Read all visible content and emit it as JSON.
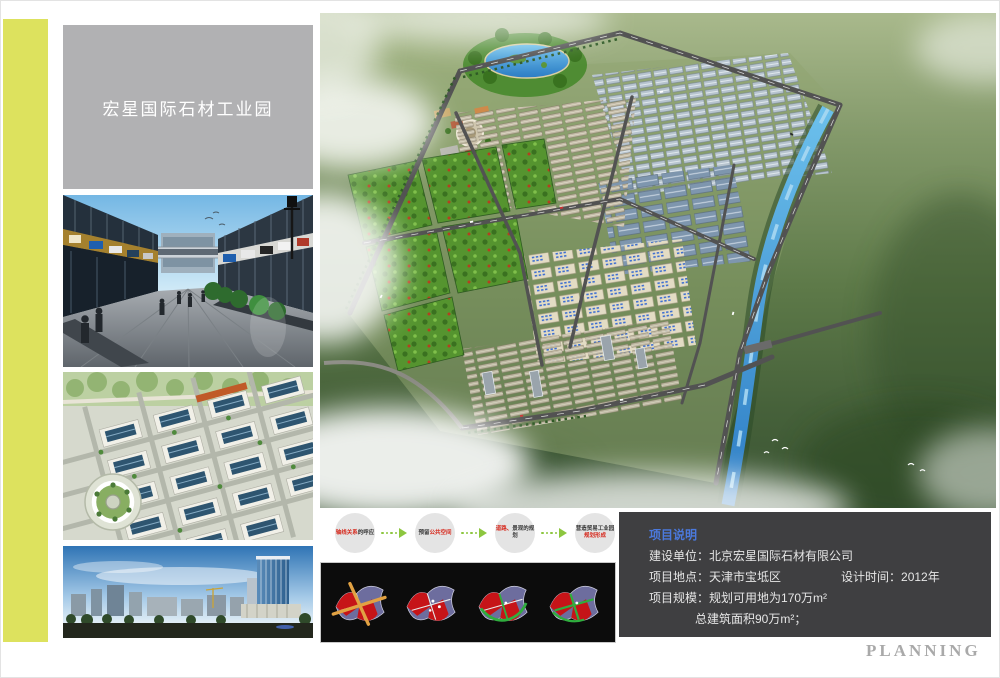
{
  "page": {
    "title_plate": "宏星国际石材工业园",
    "planning_label": "PLANNING"
  },
  "colors": {
    "accent_yellow": "#dde25e",
    "title_plate_gray": "#b1b1b3",
    "info_panel_bg": "#3f3f41",
    "info_heading_blue": "#4b79dd",
    "flow_red": "#d6281c",
    "flow_arrow_green": "#8dc63f",
    "diagram_panel_black": "#0c0c0c"
  },
  "flow": {
    "steps": [
      {
        "part_a": "轴线关系",
        "part_a_tone": "red",
        "part_b": "的呼应",
        "part_b_tone": "dark"
      },
      {
        "part_a": "预留",
        "part_a_tone": "dark",
        "part_b": "公共空间",
        "part_b_tone": "red"
      },
      {
        "part_a": "道路、",
        "part_a_tone": "red",
        "part_b": "景观的规划",
        "part_b_tone": "dark"
      },
      {
        "part_a": "营造贸易工业园",
        "part_a_tone": "dark",
        "part_b": "规划形成",
        "part_b_tone": "red"
      }
    ]
  },
  "info": {
    "heading": "项目说明",
    "row1_label": "建设单位：",
    "row1_value": "北京宏星国际石材有限公司",
    "row2_label": "项目地点：",
    "row2_value": "天津市宝坻区",
    "row2_right_label": "设计时间：",
    "row2_right_value": "2012年",
    "row3_label": "项目规模：",
    "row3_value": "规划可用地为170万m²",
    "row4_value": "总建筑面积90万m²；"
  }
}
